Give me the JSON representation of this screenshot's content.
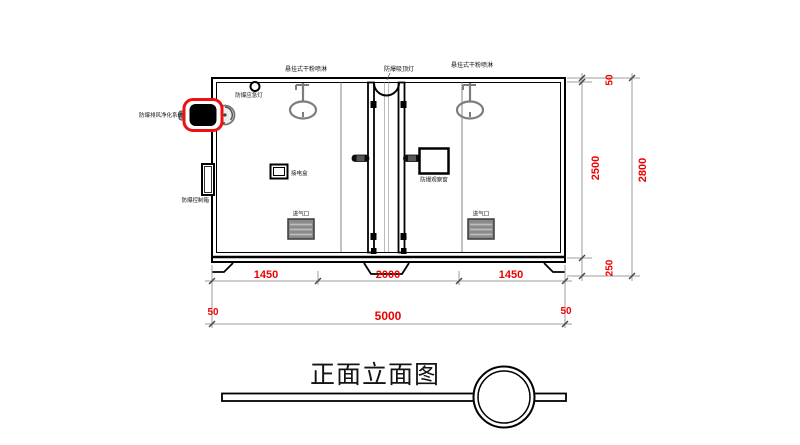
{
  "drawing": {
    "title": "正面立面图",
    "equipment_labels": {
      "sprinkler_left": "悬挂式干粉喷淋",
      "ceiling_lamp": "防爆吸顶灯",
      "sprinkler_right": "悬挂式干粉喷淋",
      "emergency_lamp": "防爆应急灯",
      "purifier_system": "防爆排风净化系统",
      "control_box": "防爆控制箱",
      "junction_box": "接电盒",
      "observation_window": "防爆观察窗",
      "air_inlet_left": "进气口",
      "air_inlet_right": "进气口"
    },
    "dimensions": {
      "bottom_row1": [
        "1450",
        "2000",
        "1450"
      ],
      "bottom_margin_left": "50",
      "bottom_total": "5000",
      "bottom_margin_right": "50",
      "right_roof": "50",
      "right_cabin_height": "2500",
      "right_base_height": "250",
      "right_total_height": "2800"
    },
    "colors": {
      "dimension_text": "#ee0000",
      "highlight_red": "#ee1111",
      "line_black": "#000000",
      "device_gray": "#7d7d7d"
    }
  }
}
